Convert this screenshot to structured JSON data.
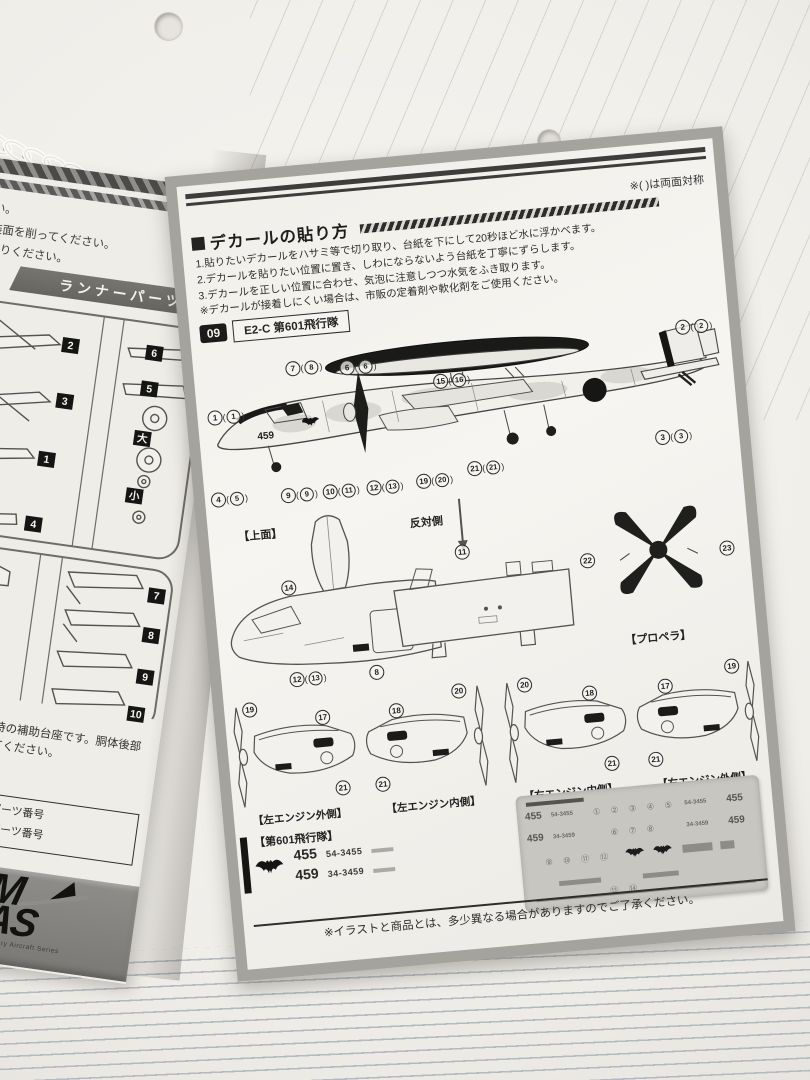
{
  "right_page": {
    "mirror_note": "※( )は両面対称",
    "decal_howto": {
      "title": "デカールの貼り方",
      "steps": [
        "1.貼りたいデカールをハサミ等で切り取り、台紙を下にして20秒ほど水に浮かべます。",
        "2.デカールを貼りたい位置に置き、しわにならないよう台紙を丁寧にずらします。",
        "3.デカールを正しい位置に合わせ、気泡に注意しつつ水気をふき取ります。"
      ],
      "note": "※デカールが接着しにくい場合は、市販の定着剤や軟化剤をご使用ください。"
    },
    "variant": {
      "number": "09",
      "name": "E2-C 第601飛行隊"
    },
    "aircraft": {
      "modex_on_nose": "459",
      "callouts": [
        {
          "n": "1",
          "alt": "1",
          "x": 4,
          "y": 60
        },
        {
          "n": "7",
          "alt": "8",
          "x": 86,
          "y": 18
        },
        {
          "n": "6",
          "alt": "6",
          "x": 140,
          "y": 22
        },
        {
          "n": "15",
          "alt": "16",
          "x": 232,
          "y": 44
        },
        {
          "n": "2",
          "alt": "2",
          "x": 478,
          "y": 12
        },
        {
          "n": "3",
          "alt": "3",
          "x": 448,
          "y": 120
        },
        {
          "n": "4",
          "alt": "5",
          "x": 0,
          "y": 142
        },
        {
          "n": "9",
          "alt": "9",
          "x": 70,
          "y": 144
        },
        {
          "n": "10",
          "alt": "11",
          "x": 112,
          "y": 144
        },
        {
          "n": "12",
          "alt": "13",
          "x": 156,
          "y": 144
        },
        {
          "n": "19",
          "alt": "20",
          "x": 206,
          "y": 142
        },
        {
          "n": "21",
          "alt": "21",
          "x": 258,
          "y": 134
        }
      ]
    },
    "labels": {
      "top_view": "【上面】",
      "opposite_side": "反対側",
      "propeller": "【プロペラ】"
    },
    "mid_callouts": [
      {
        "n": "14",
        "x": 62,
        "y": 66
      },
      {
        "n": "12",
        "alt": "13",
        "x": 62,
        "y": 158
      },
      {
        "n": "8",
        "x": 142,
        "y": 158
      },
      {
        "n": "11",
        "x": 238,
        "y": 46
      }
    ],
    "prop_callouts": [
      {
        "n": "22",
        "x": 0,
        "y": 66
      },
      {
        "n": "23",
        "x": 140,
        "y": 66
      }
    ],
    "engine_views": [
      {
        "caption": "【左エンジン外側】",
        "callouts": [
          {
            "n": "19",
            "x": 16,
            "y": 0
          },
          {
            "n": "17",
            "x": 88,
            "y": 14
          },
          {
            "n": "21",
            "x": 102,
            "y": 86
          }
        ]
      },
      {
        "caption": "【左エンジン内側】",
        "callouts": [
          {
            "n": "18",
            "x": 28,
            "y": 14
          },
          {
            "n": "20",
            "x": 92,
            "y": 0
          },
          {
            "n": "21",
            "x": 8,
            "y": 86
          }
        ]
      },
      {
        "caption": "【右エンジン内側】",
        "callouts": [
          {
            "n": "20",
            "x": 20,
            "y": 0
          },
          {
            "n": "18",
            "x": 84,
            "y": 14
          },
          {
            "n": "21",
            "x": 100,
            "y": 86
          }
        ]
      },
      {
        "caption": "【右エンジン外側】",
        "callouts": [
          {
            "n": "17",
            "x": 26,
            "y": 14
          },
          {
            "n": "19",
            "x": 94,
            "y": 0
          },
          {
            "n": "21",
            "x": 10,
            "y": 86
          }
        ]
      }
    ],
    "squadron": {
      "title": "【第601飛行隊】",
      "rows": [
        {
          "modex": "455",
          "serial": "54-3455"
        },
        {
          "modex": "459",
          "serial": "34-3459"
        }
      ]
    },
    "decal_sheet": {
      "modex_left_1": "455",
      "serial_left_1": "54-3455",
      "modex_left_2": "459",
      "serial_left_2": "34-3459",
      "serial_right_1": "54-3455",
      "modex_right_1": "455",
      "serial_right_2": "34-3459",
      "modex_right_2": "459",
      "numbers_row1": "① ② ③ ④ ⑤",
      "numbers_row2": "⑥ ⑦ ⑧",
      "numbers_row3": "⑨ ⑩ ⑪ ⑫",
      "numbers_row4": "⑬ ⑭"
    },
    "footer_note": "※イラストと商品とは、多少異なる場合がありますのでご了承ください。"
  },
  "left_page": {
    "cut_lines": [
      "さい。",
      "塗装面を削ってください。",
      "お送りください。"
    ],
    "banner": "ランナーパーツ",
    "part_tags": [
      {
        "t": "2",
        "x": 112,
        "y": 30
      },
      {
        "t": "6",
        "x": 196,
        "y": 26
      },
      {
        "t": "3",
        "x": 114,
        "y": 86
      },
      {
        "t": "5",
        "x": 196,
        "y": 62
      },
      {
        "t": "1",
        "x": 104,
        "y": 146
      },
      {
        "t": "大",
        "x": 196,
        "y": 112
      },
      {
        "t": "4",
        "x": 100,
        "y": 212
      },
      {
        "t": "小",
        "x": 196,
        "y": 170
      },
      {
        "t": "7",
        "x": 232,
        "y": 266
      },
      {
        "t": "8",
        "x": 232,
        "y": 306
      },
      {
        "t": "9",
        "x": 232,
        "y": 348
      },
      {
        "t": "10",
        "x": 228,
        "y": 386
      }
    ],
    "support_note": "着陸状態時の補助台座です。胴体後部に配置してください。",
    "bracket_fragment": "ーツ】",
    "legend_lines": [
      "状態で使用するパーツ番号",
      "状態で使用するパーツ番号"
    ],
    "logo": {
      "partial_letter": "F",
      "m": "M",
      "as": "AS",
      "series": "Military Aircraft Series"
    }
  }
}
